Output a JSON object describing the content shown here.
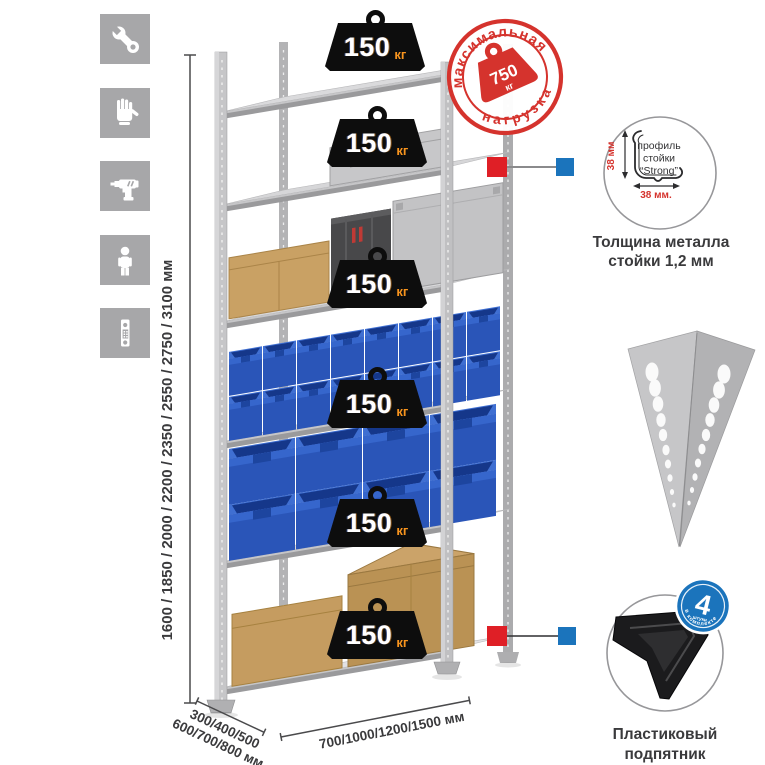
{
  "left_icons": [
    {
      "name": "wrench"
    },
    {
      "name": "gloves"
    },
    {
      "name": "drill"
    },
    {
      "name": "person"
    },
    {
      "name": "post-profile-piece"
    }
  ],
  "dimensions": {
    "height": "1600 / 1850 / 2000 / 2200 / 2350 / 2550 / 2750 / 3100 мм",
    "depth_line1": "300/400/500",
    "depth_line2": "600/700/800 мм",
    "width": "700/1000/1200/1500 мм"
  },
  "shelf_badges": [
    {
      "value": "150",
      "unit": "кг"
    },
    {
      "value": "150",
      "unit": "кг"
    },
    {
      "value": "150",
      "unit": "кг"
    },
    {
      "value": "150",
      "unit": "кг"
    },
    {
      "value": "150",
      "unit": "кг"
    },
    {
      "value": "150",
      "unit": "кг"
    }
  ],
  "max_load_stamp": {
    "arc_top": "максимальная",
    "arc_bottom": "нагрузка",
    "value": "750",
    "unit": "кг"
  },
  "profile_feature": {
    "label_line1": "профиль",
    "label_line2": "стойки",
    "label_line3": "“Strong”",
    "dim_vertical": "38 мм",
    "dim_horizontal": "38 мм.",
    "caption_line1": "Толщина металла",
    "caption_line2": "стойки 1,2 мм"
  },
  "foot_feature": {
    "badge_count": "4",
    "badge_unit": "штуки",
    "badge_arc": "в комплекте",
    "caption_line1": "Пластиковый",
    "caption_line2": "подпятник"
  },
  "colors": {
    "accent_red": "#d5332d",
    "connector_red": "#df1f26",
    "accent_blue": "#1b74bc",
    "badge_black": "#0d0d0d",
    "badge_unit_orange": "#f7941e",
    "icon_tile_gray": "#a7a7a9",
    "bin_blue": "#2a55b8",
    "carton_brown": "#c9a164",
    "metal_light": "#dadadc",
    "metal_mid": "#b2b2b4"
  }
}
